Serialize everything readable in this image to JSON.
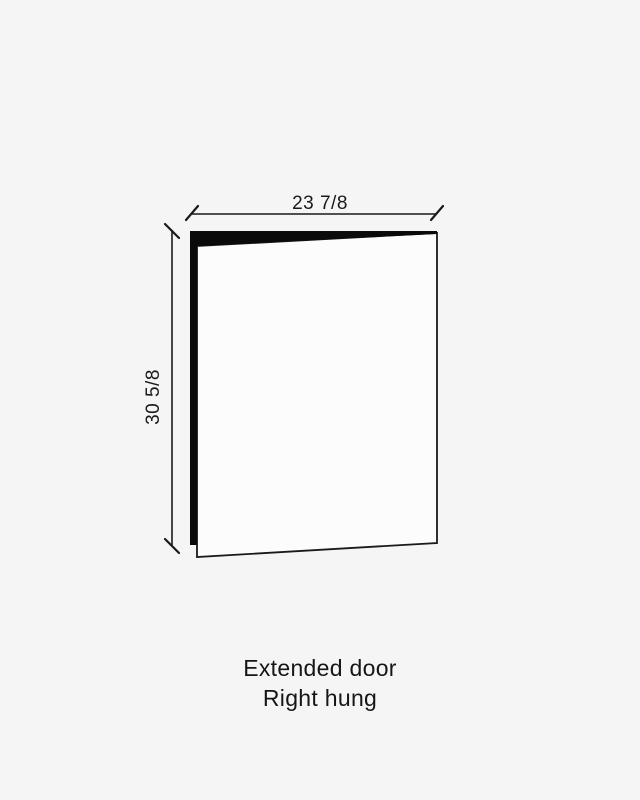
{
  "colors": {
    "background": "#f5f5f5",
    "ink": "#1a1a1a",
    "door_face": "#fcfcfc"
  },
  "diagram": {
    "type": "door-spec-drawing",
    "width_dimension": "23 7/8",
    "height_dimension": "30 5/8"
  },
  "caption": {
    "line1": "Extended door",
    "line2": "Right hung"
  }
}
